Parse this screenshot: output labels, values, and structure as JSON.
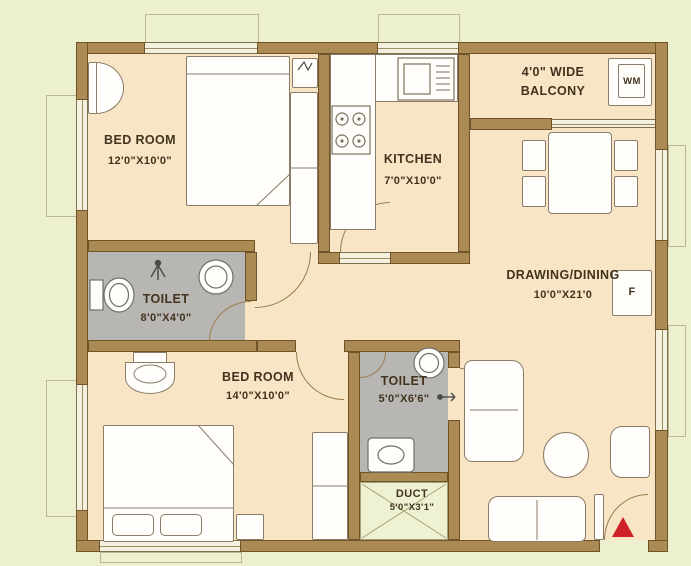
{
  "rooms": {
    "bedroom1": {
      "name": "BED ROOM",
      "dims": "12'0\"X10'0\""
    },
    "kitchen": {
      "name": "KITCHEN",
      "dims": "7'0\"X10'0\""
    },
    "balcony": {
      "line1": "4'0\"  WIDE",
      "line2": "BALCONY"
    },
    "drawing_dining": {
      "name": "DRAWING/DINING",
      "dims": "10'0\"X21'0"
    },
    "toilet1": {
      "name": "TOILET",
      "dims": "8'0\"X4'0\""
    },
    "bedroom2": {
      "name": "BED ROOM",
      "dims": "14'0\"X10'0\""
    },
    "toilet2": {
      "name": "TOILET",
      "dims": "5'0\"X6'6\""
    },
    "duct": {
      "name": "DUCT",
      "dims": "5'0\"X3'1\""
    }
  },
  "appliances": {
    "washing_machine": "WM",
    "fridge": "F"
  },
  "colors": {
    "outside": "#edf0ce",
    "wall": "#ac8a54",
    "floor": "#f8e5c6",
    "toilet_floor": "#b8b6b2",
    "duct_floor": "#eff2d2",
    "label_text": "#42331f",
    "entry_arrow": "#ce2127"
  }
}
